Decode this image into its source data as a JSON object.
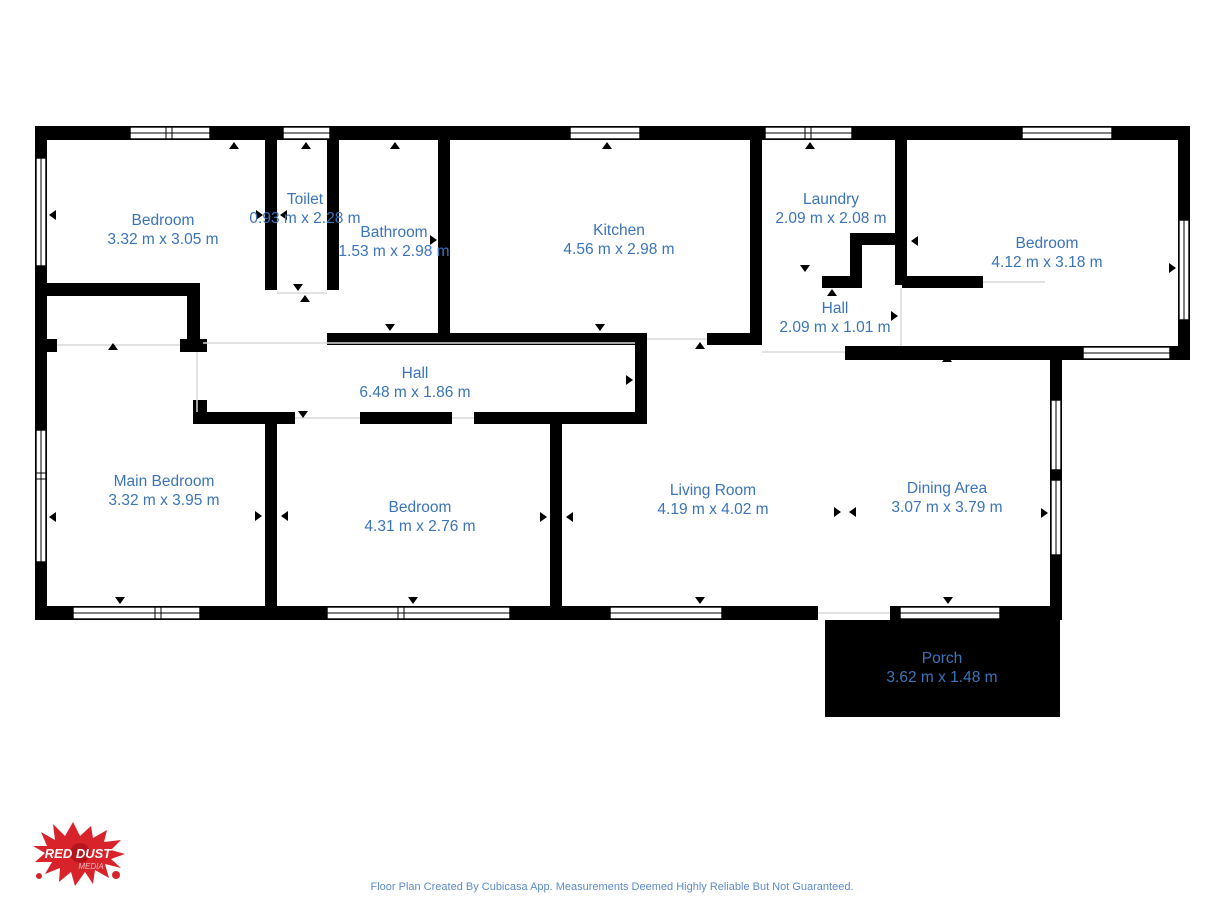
{
  "plan": {
    "wall_color": "#000000",
    "label_color": "#3b74ba",
    "rooms": [
      {
        "name": "Bedroom",
        "dims": "3.32 m x 3.05 m"
      },
      {
        "name": "Toilet",
        "dims": "0.93 m x 2.28 m"
      },
      {
        "name": "Bathroom",
        "dims": "1.53 m x 2.98 m"
      },
      {
        "name": "Kitchen",
        "dims": "4.56 m x 2.98 m"
      },
      {
        "name": "Laundry",
        "dims": "2.09 m x 2.08 m"
      },
      {
        "name": "Bedroom",
        "dims": "4.12 m x 3.18 m"
      },
      {
        "name": "Hall",
        "dims": "2.09 m x 1.01 m"
      },
      {
        "name": "Hall",
        "dims": "6.48 m x 1.86 m"
      },
      {
        "name": "Main Bedroom",
        "dims": "3.32 m x 3.95 m"
      },
      {
        "name": "Bedroom",
        "dims": "4.31 m x 2.76 m"
      },
      {
        "name": "Living Room",
        "dims": "4.19 m x 4.02 m"
      },
      {
        "name": "Dining Area",
        "dims": "3.07 m x 3.79 m"
      },
      {
        "name": "Porch",
        "dims": "3.62 m x 1.48 m"
      }
    ]
  },
  "logo": {
    "brand": "RED DUST",
    "tagline": "MEDIA",
    "color": "#d8232a"
  },
  "footer": {
    "text": "Floor Plan Created By Cubicasa App. Measurements Deemed Highly Reliable But Not Guaranteed."
  }
}
